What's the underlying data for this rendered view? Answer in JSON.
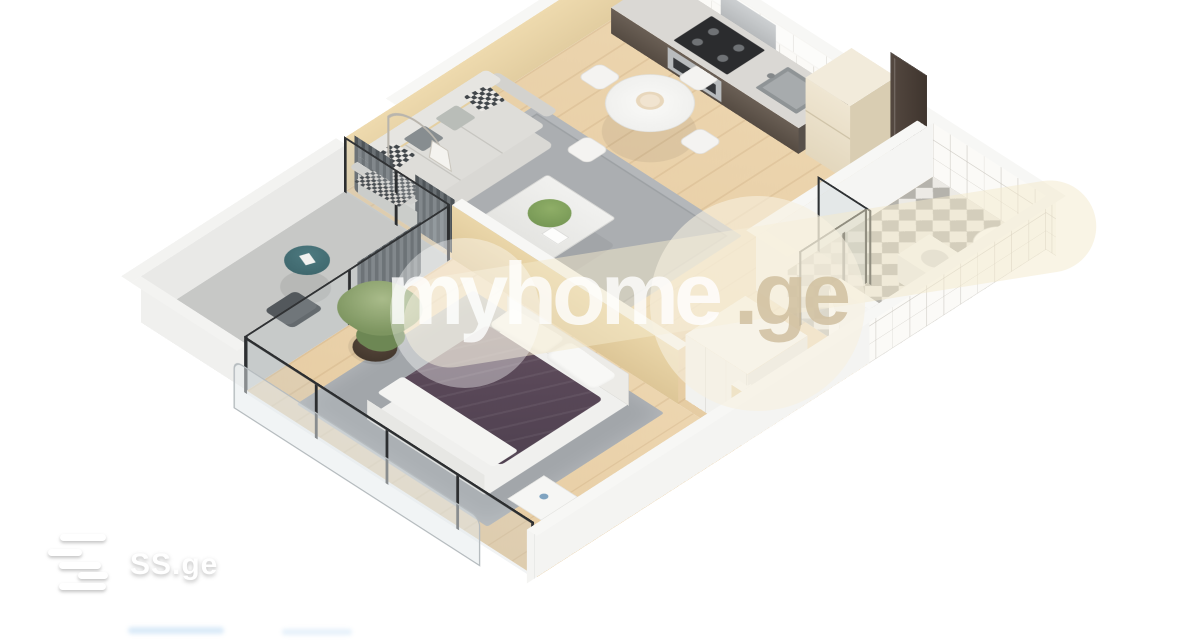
{
  "watermark": {
    "brand": "myhome",
    "tld": ".ge"
  },
  "logo": {
    "text": "SS.ge"
  },
  "floorplan": {
    "type": "3d-isometric-apartment-render",
    "rooms": [
      {
        "name": "living-room",
        "furniture": [
          "sofa",
          "throw-pillows",
          "plaid-blanket",
          "rug",
          "coffee-table",
          "plant",
          "arc-floor-lamp",
          "dining-table",
          "dining-chairs"
        ]
      },
      {
        "name": "kitchen",
        "furniture": [
          "counter",
          "stove",
          "oven",
          "range-hood",
          "sink",
          "upper-cabinets",
          "refrigerator"
        ]
      },
      {
        "name": "entrance",
        "furniture": [
          "entrance-door"
        ]
      },
      {
        "name": "bathroom",
        "furniture": [
          "shower-enclosure",
          "toilet",
          "washbasin",
          "tiled-walls",
          "mosaic-floor"
        ]
      },
      {
        "name": "hallway",
        "furniture": [
          "wardrobe",
          "bathroom-door"
        ]
      },
      {
        "name": "bedroom",
        "furniture": [
          "double-bed",
          "pillows",
          "rug",
          "potted-plant",
          "nightstand",
          "window-wall"
        ]
      },
      {
        "name": "balcony",
        "furniture": [
          "cafe-table",
          "chair",
          "curtains",
          "glass-balustrade"
        ]
      }
    ],
    "colors": {
      "background": "#ffffff",
      "floor_wood": "#ebd2a9",
      "wall_top": "#f7f7f5",
      "wall_accent_beige": "#e8d3a4",
      "bed_duvet_plum": "#5c4a57",
      "balcony_floor": "#c7c8c6",
      "cafe_table_teal": "#416a70",
      "frame_dark": "#2c2e30",
      "entrance_door": "#4a3e36"
    }
  }
}
